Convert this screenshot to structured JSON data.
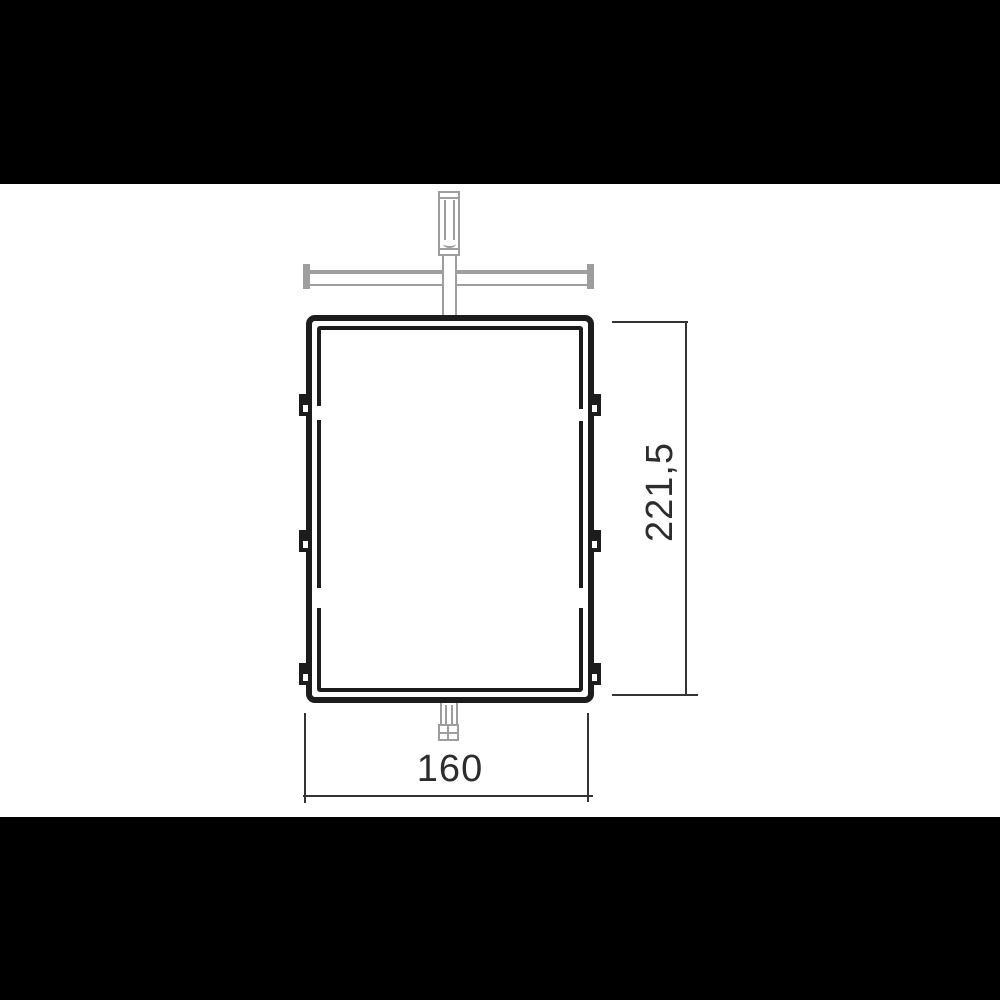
{
  "diagram": {
    "type": "technical-drawing",
    "description": "Front view of a rectangular frame with mounting hardware and two dimension callouts",
    "dimensions": {
      "width_label": "160",
      "height_label": "221,5"
    },
    "colors": {
      "background": "#ffffff",
      "letterbox": "#000000",
      "frame_line": "#1c1c1c",
      "hardware_gray": "#9e9e9e",
      "dimension_line": "#333333",
      "label_text": "#2d2d2d"
    }
  }
}
